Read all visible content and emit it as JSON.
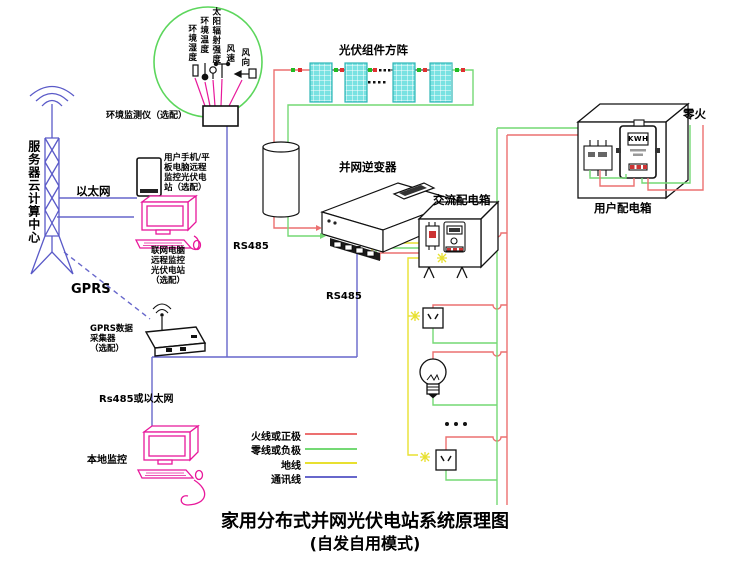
{
  "diagram_title": {
    "main": "家用分布式并网光伏电站系统原理图",
    "sub": "(自发自用模式)"
  },
  "env_monitoring": {
    "sensor_labels": [
      "环境湿度",
      "环境温度",
      "太阳辐射强度",
      "风速",
      "风向"
    ],
    "station_label": "环境监测仪（选配）"
  },
  "cloud": {
    "server_label": "服务器云计算中心",
    "ethernet_label": "以太网",
    "gprs_label": "GPRS"
  },
  "remote_devices": {
    "phone_note": [
      "用户手机/平",
      "板电脑远程",
      "监控光伏电",
      "站（选配）"
    ],
    "pc_note": [
      "联网电脑",
      "远程监控",
      "光伏电站",
      "（选配）"
    ],
    "collector_note": [
      "GPRS数据",
      "采集器",
      "（选配）"
    ],
    "local_monitor_label": "本地监控",
    "rs485_or_ethernet_label": "Rs485或以太网"
  },
  "pv_system": {
    "array_label": "光伏组件方阵",
    "inverter_label": "并网逆变器",
    "rs485_label_left": "RS485",
    "rs485_label_right": "RS485",
    "ac_box_label": "交流配电箱",
    "user_box_label": "用户配电箱",
    "meter_display": "KWH",
    "grid_wires_label": "零火"
  },
  "legend": {
    "items": [
      {
        "label": "火线或正极",
        "color": "#ec7070"
      },
      {
        "label": "零线或负极",
        "color": "#74d974"
      },
      {
        "label": "地线",
        "color": "#e8e030"
      },
      {
        "label": "通讯线",
        "color": "#6767cb"
      }
    ]
  },
  "colors": {
    "live_wire": "#ec7070",
    "neutral_wire": "#74d974",
    "ground_wire": "#e8e030",
    "comm_wire": "#6767cb",
    "device_magenta": "#e8189b",
    "panel_cyan": "#79e2e2",
    "ellipse_green": "#5cd65c"
  }
}
